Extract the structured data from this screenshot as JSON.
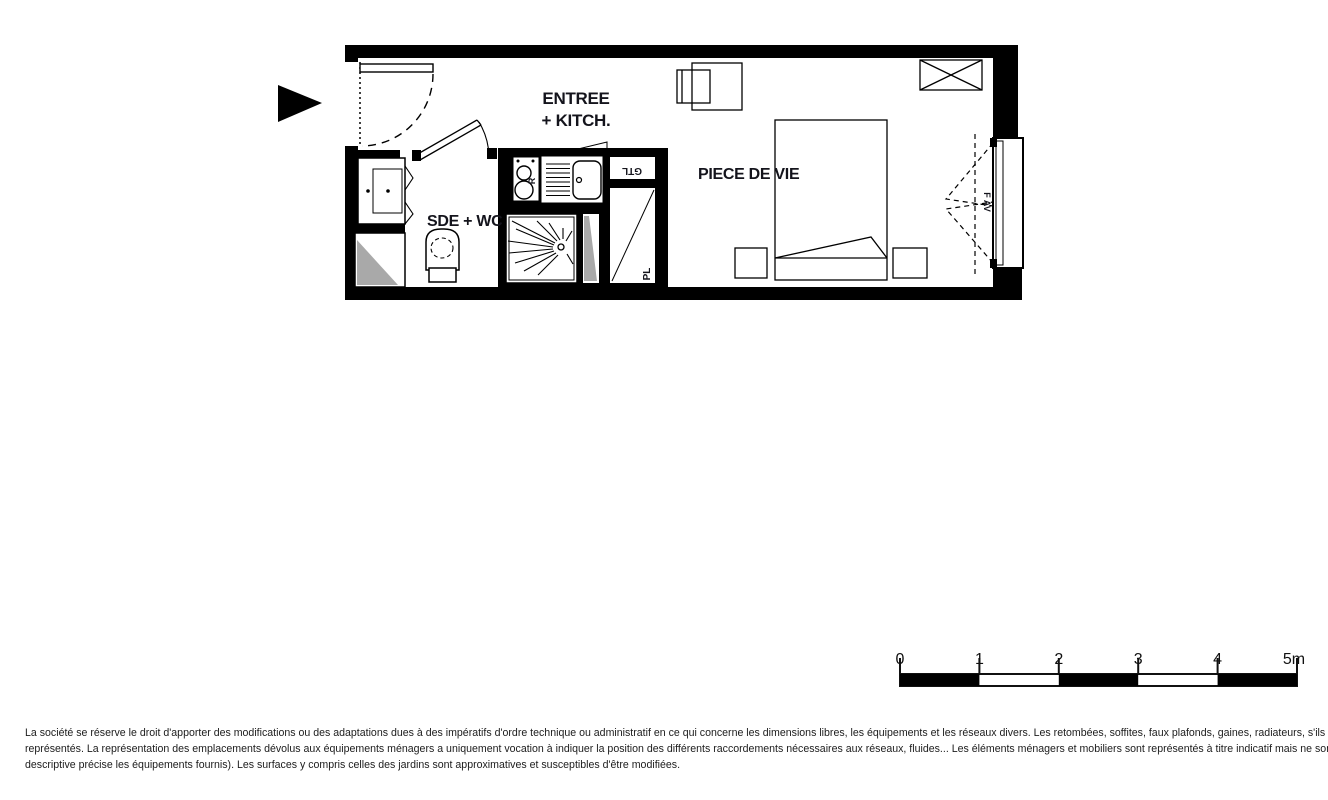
{
  "plan": {
    "labels": {
      "entree_line1": "ENTREE",
      "entree_line2": "+ KITCH.",
      "piece_de_vie": "PIECE DE VIE",
      "sde_wc": "SDE + WC",
      "gtl": "GTL",
      "pl": "PL",
      "cooktop_r": "R",
      "window_fav": "F AV"
    },
    "colors": {
      "wall": "#000000",
      "duct_shading": "#a9a9a9",
      "label_text": "#14141c"
    }
  },
  "scale_bar": {
    "unit_note": "meters",
    "ticks": [
      "0",
      "1",
      "2",
      "3",
      "4",
      "5m"
    ]
  },
  "disclaimer": {
    "lines": [
      "La société se réserve le droit d'apporter des modifications ou des adaptations dues à des impératifs d'ordre technique ou administratif en ce qui concerne les dimensions libres, les équipements et les réseaux divers. Les retombées, soffites, faux plafonds, gaines, radiateurs, s'ils existent, ne sont pas tous",
      "représentés. La représentation des emplacements dévolus aux équipements ménagers a uniquement vocation à indiquer la position des différents raccordements nécessaires aux réseaux, fluides... Les éléments ménagers et mobiliers sont représentés à titre indicatif mais ne sont pas tous fournis (seule la notice",
      "descriptive précise les équipements fournis). Les surfaces y compris celles des jardins sont approximatives et susceptibles d'être modifiées."
    ]
  }
}
